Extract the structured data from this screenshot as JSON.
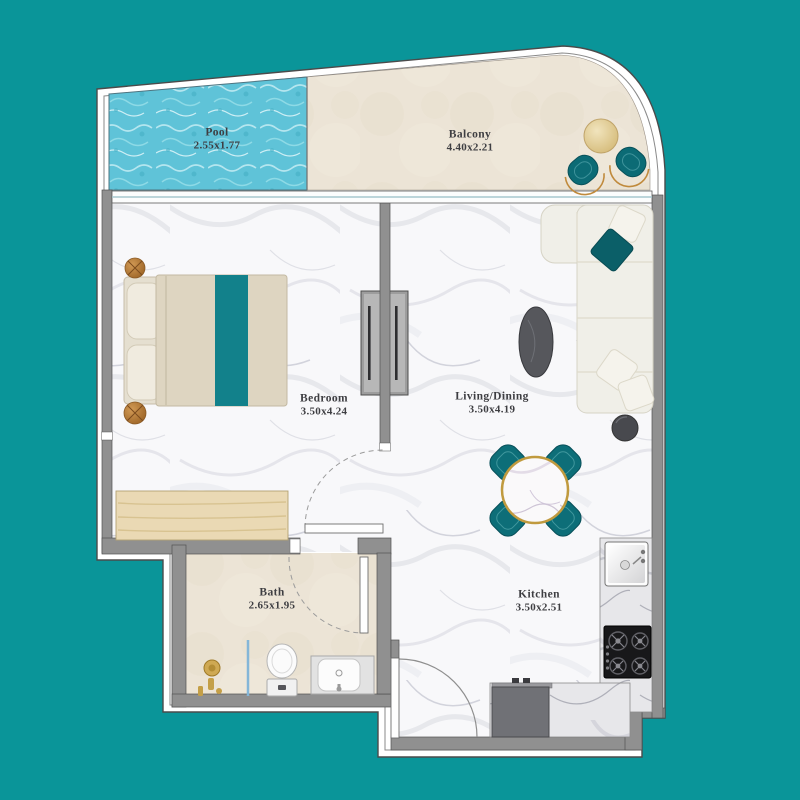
{
  "rooms": [
    {
      "name": "Pool",
      "dims": "2.55x1.77"
    },
    {
      "name": "Balcony",
      "dims": "4.40x2.21"
    },
    {
      "name": "Bedroom",
      "dims": "3.50x4.24"
    },
    {
      "name": "Living/Dining",
      "dims": "3.50x4.19"
    },
    {
      "name": "Bath",
      "dims": "2.65x1.95"
    },
    {
      "name": "Kitchen",
      "dims": "3.50x2.51"
    }
  ],
  "colors": {
    "background_teal": "#0a9599",
    "furniture_teal": "#0d6e78",
    "bed_runner_teal": "#12818b",
    "wall_gray": "#909090",
    "pool_blue": "#5fc3d8",
    "floor_beige": "#ece4d6",
    "wood_tan": "#ead9b4",
    "copper": "#b5793b",
    "gold_rim": "#c09a3e",
    "label_text": "#3e3e42"
  }
}
